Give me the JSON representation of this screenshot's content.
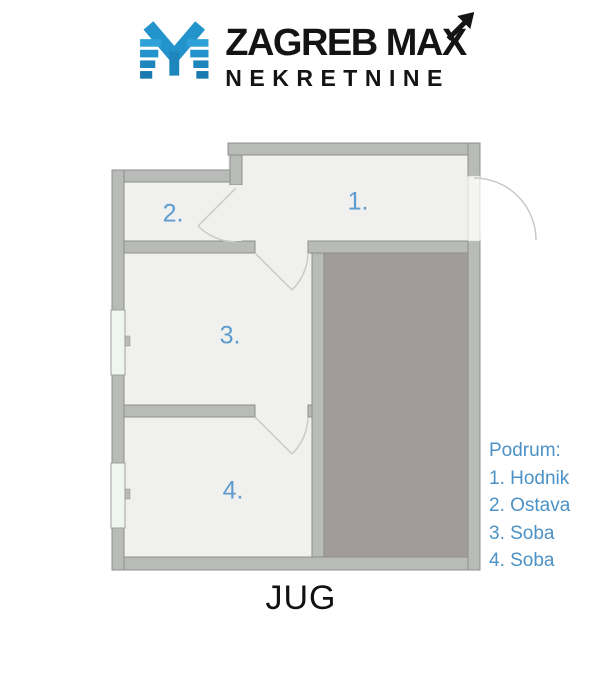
{
  "logo": {
    "brand_line1": "ZAGREB MAX",
    "brand_line2": "NEKRETNINE",
    "icon": "zagreb-max-m-icon"
  },
  "floorplan": {
    "room_labels": [
      {
        "id": "room-1",
        "label": "1."
      },
      {
        "id": "room-2",
        "label": "2."
      },
      {
        "id": "room-3",
        "label": "3."
      },
      {
        "id": "room-4",
        "label": "4."
      }
    ]
  },
  "legend": {
    "title": "Podrum:",
    "items": [
      {
        "text": "1. Hodnik"
      },
      {
        "text": "2. Ostava"
      },
      {
        "text": "3. Soba"
      },
      {
        "text": "4. Soba"
      }
    ]
  },
  "compass": {
    "label": "JUG"
  },
  "colors": {
    "logo_blue": "#2293CB",
    "room_label_blue": "#5E9CCF",
    "legend_blue": "#4C92C6",
    "wall_gray": "#B9BBB8",
    "floor_light": "#F0F0EE",
    "solid_fill_gray": "#A19C99"
  }
}
